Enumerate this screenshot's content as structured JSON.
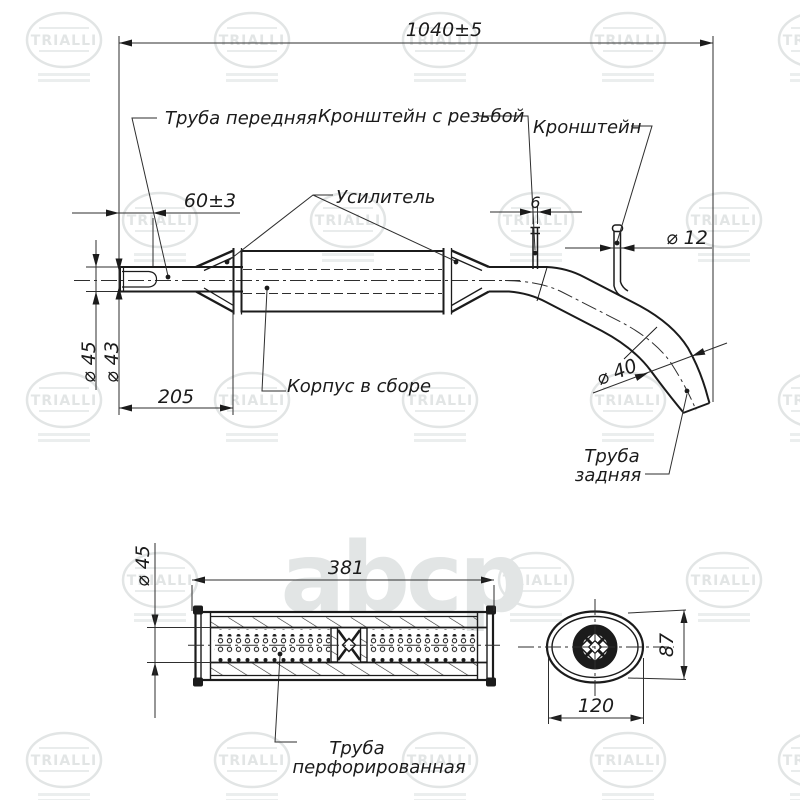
{
  "drawing": {
    "labels": {
      "front_pipe": "Труба передняя",
      "bracket_threaded": "Кронштейн с резьбой",
      "bracket": "Кронштейн",
      "reinforcement": "Усилитель",
      "body_assembly": "Корпус в сборе",
      "rear_pipe_line1": "Труба",
      "rear_pipe_line2": "задняя",
      "perforated_line1": "Труба",
      "perforated_line2": "перфорированная"
    },
    "dims": {
      "overall": "1040±5",
      "sleeve": "60±3",
      "rod_width": "6",
      "rod_dia": "⌀ 12",
      "pipe_outer": "⌀ 45",
      "pipe_inner": "⌀ 43",
      "front_len": "205",
      "rear_dia": "⌀ 40",
      "body_len": "381",
      "perf_dia": "⌀ 45",
      "body_h": "87",
      "body_w": "120"
    },
    "watermark": {
      "brand": "TRIALLI",
      "logo": "abcp",
      "color": "#e2e5e5"
    },
    "line_color": "#1b1b1b",
    "background": "#ffffff"
  }
}
